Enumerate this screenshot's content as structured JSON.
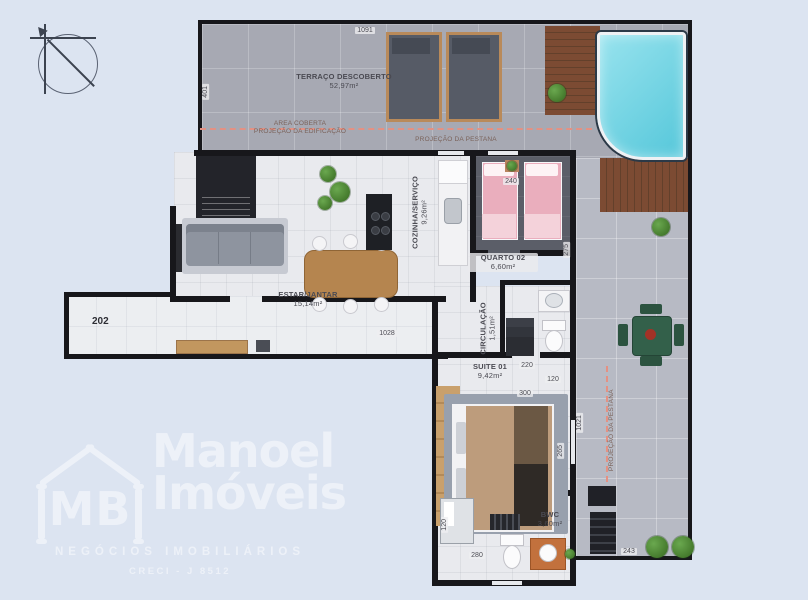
{
  "rooms": {
    "terraco": {
      "label": "TERRAÇO DESCOBERTO",
      "area": "52,97m²"
    },
    "cozinha": {
      "label": "COZINHA/SERVIÇO",
      "area": "9,26m²"
    },
    "quarto02": {
      "label": "QUARTO 02",
      "area": "6,60m²"
    },
    "estar_jantar": {
      "label": "ESTAR/JANTAR",
      "area": "15,14m²"
    },
    "circulacao": {
      "label": "CIRCULAÇÃO",
      "area": "1,51m²"
    },
    "suite01": {
      "label": "SUITE 01",
      "area": "9,42m²"
    },
    "bwc": {
      "label": "BWC",
      "area": "3,60m²"
    }
  },
  "annotations": {
    "area_coberta_line1": "AREA COBERTA",
    "area_coberta_line2": "PROJEÇÃO DA EDIFICAÇÃO",
    "pestana_top": "PROJEÇÃO DA PESTANA",
    "pestana_right": "PROJEÇÃO DA PESTANA",
    "unit_number": "202"
  },
  "dimensions": {
    "terrace_width": "1091",
    "terrace_left": "401",
    "quarto_bed": "240",
    "quarto_depth": "275",
    "corridor_width": "1028",
    "circ_depth": "220",
    "wc_width": "120",
    "suite_width": "300",
    "suite_depth": "265",
    "east_height": "1021",
    "bwc_depth": "120",
    "bwc_width": "280",
    "patio_width": "243"
  },
  "logo": {
    "initials": "MB",
    "brand_line1": "Manoel",
    "brand_line2": "Imóveis",
    "subtitle": "NEGÓCIOS IMOBILIÁRIOS",
    "license": "CRECI - J 8512"
  },
  "colors": {
    "background": "#dce4f1",
    "wall": "#17171b",
    "pool_water": "#6fd4e5",
    "deck_wood": "#7c4b33",
    "dashed_line": "#e49183",
    "quarto_floor": "#5b5e68",
    "bed_pink": "#eaaebd"
  }
}
